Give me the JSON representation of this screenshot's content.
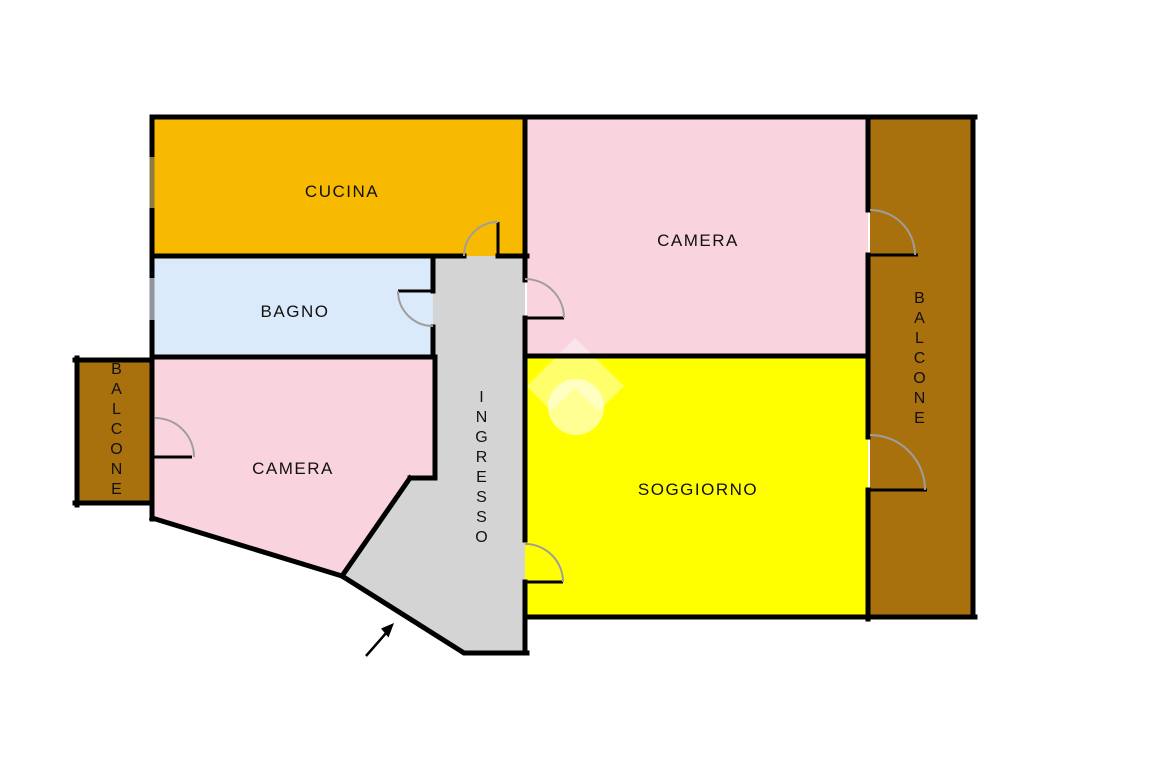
{
  "plan": {
    "rooms": {
      "cucina": {
        "label": "CUCINA",
        "color": "#F7BA00"
      },
      "camera_nord": {
        "label": "CAMERA",
        "color": "#F9D3DE"
      },
      "bagno": {
        "label": "BAGNO",
        "color": "#DAEAFA"
      },
      "camera_sud": {
        "label": "CAMERA",
        "color": "#F9D3DE"
      },
      "ingresso": {
        "label": "INGRESSO",
        "color": "#D4D4D4"
      },
      "soggiorno": {
        "label": "SOGGIORNO",
        "color": "#FFFF00"
      },
      "balcone_sx": {
        "label": "BALCONE",
        "color": "#A9700E"
      },
      "balcone_dx": {
        "label": "BALCONE",
        "color": "#A9700E"
      }
    },
    "colors": {
      "wall": "#000000",
      "door_leaf": "#000000",
      "door_arc": "#9E9E9E",
      "window_cucina": "#8D7B45",
      "window_bagno": "#8F959B",
      "watermark": "#FFFFFF",
      "arrow": "#000000",
      "background": "#FFFFFF"
    },
    "icons": {
      "watermark": "house-logo-watermark",
      "arrow": "entrance-direction-arrow"
    }
  }
}
